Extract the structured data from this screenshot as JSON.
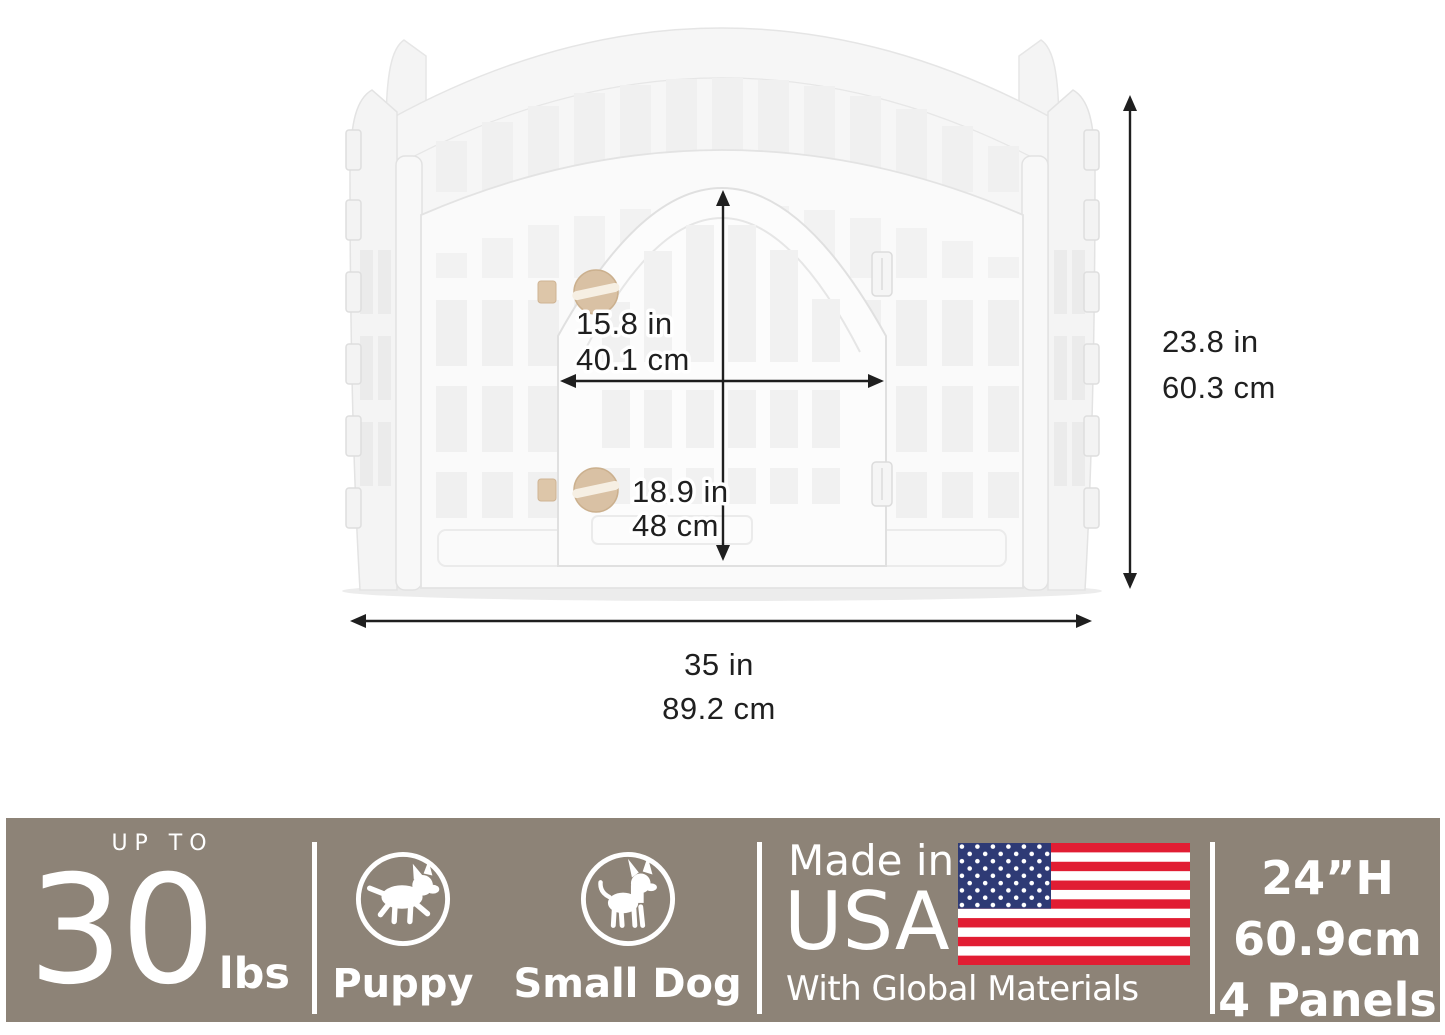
{
  "product_diagram": {
    "description": "white 4-panel plastic pet playpen with front door, shown with dimension arrows",
    "dimensions": {
      "door_width": {
        "inches": "15.8 in",
        "metric": "40.1 cm"
      },
      "door_height": {
        "inches": "18.9 in",
        "metric": "48 cm"
      },
      "pen_height": {
        "inches": "23.8 in",
        "metric": "60.3 cm"
      },
      "pen_width": {
        "inches": "35 in",
        "metric": "89.2 cm"
      }
    }
  },
  "banner": {
    "weight": {
      "prefix": "UP TO",
      "value": "30",
      "unit": "lbs"
    },
    "pets": [
      {
        "label": "Puppy",
        "icon": "puppy-icon"
      },
      {
        "label": "Small Dog",
        "icon": "small-dog-icon"
      }
    ],
    "origin": {
      "line1": "Made in",
      "line2": "USA",
      "line3": "With Global Materials",
      "flag_icon": "us-flag"
    },
    "specs": {
      "height_imperial": "24”H",
      "height_metric": "60.9cm",
      "panel_count": "4 Panels"
    }
  },
  "colors": {
    "banner_background": "#8d8377",
    "banner_text": "#ffffff",
    "flag_red": "#e11d33",
    "flag_blue": "#2e3a75",
    "knob_tan": "#d9c1a4",
    "dimension_lines": "#1f1f1f",
    "pen_white": "#fafafa"
  }
}
